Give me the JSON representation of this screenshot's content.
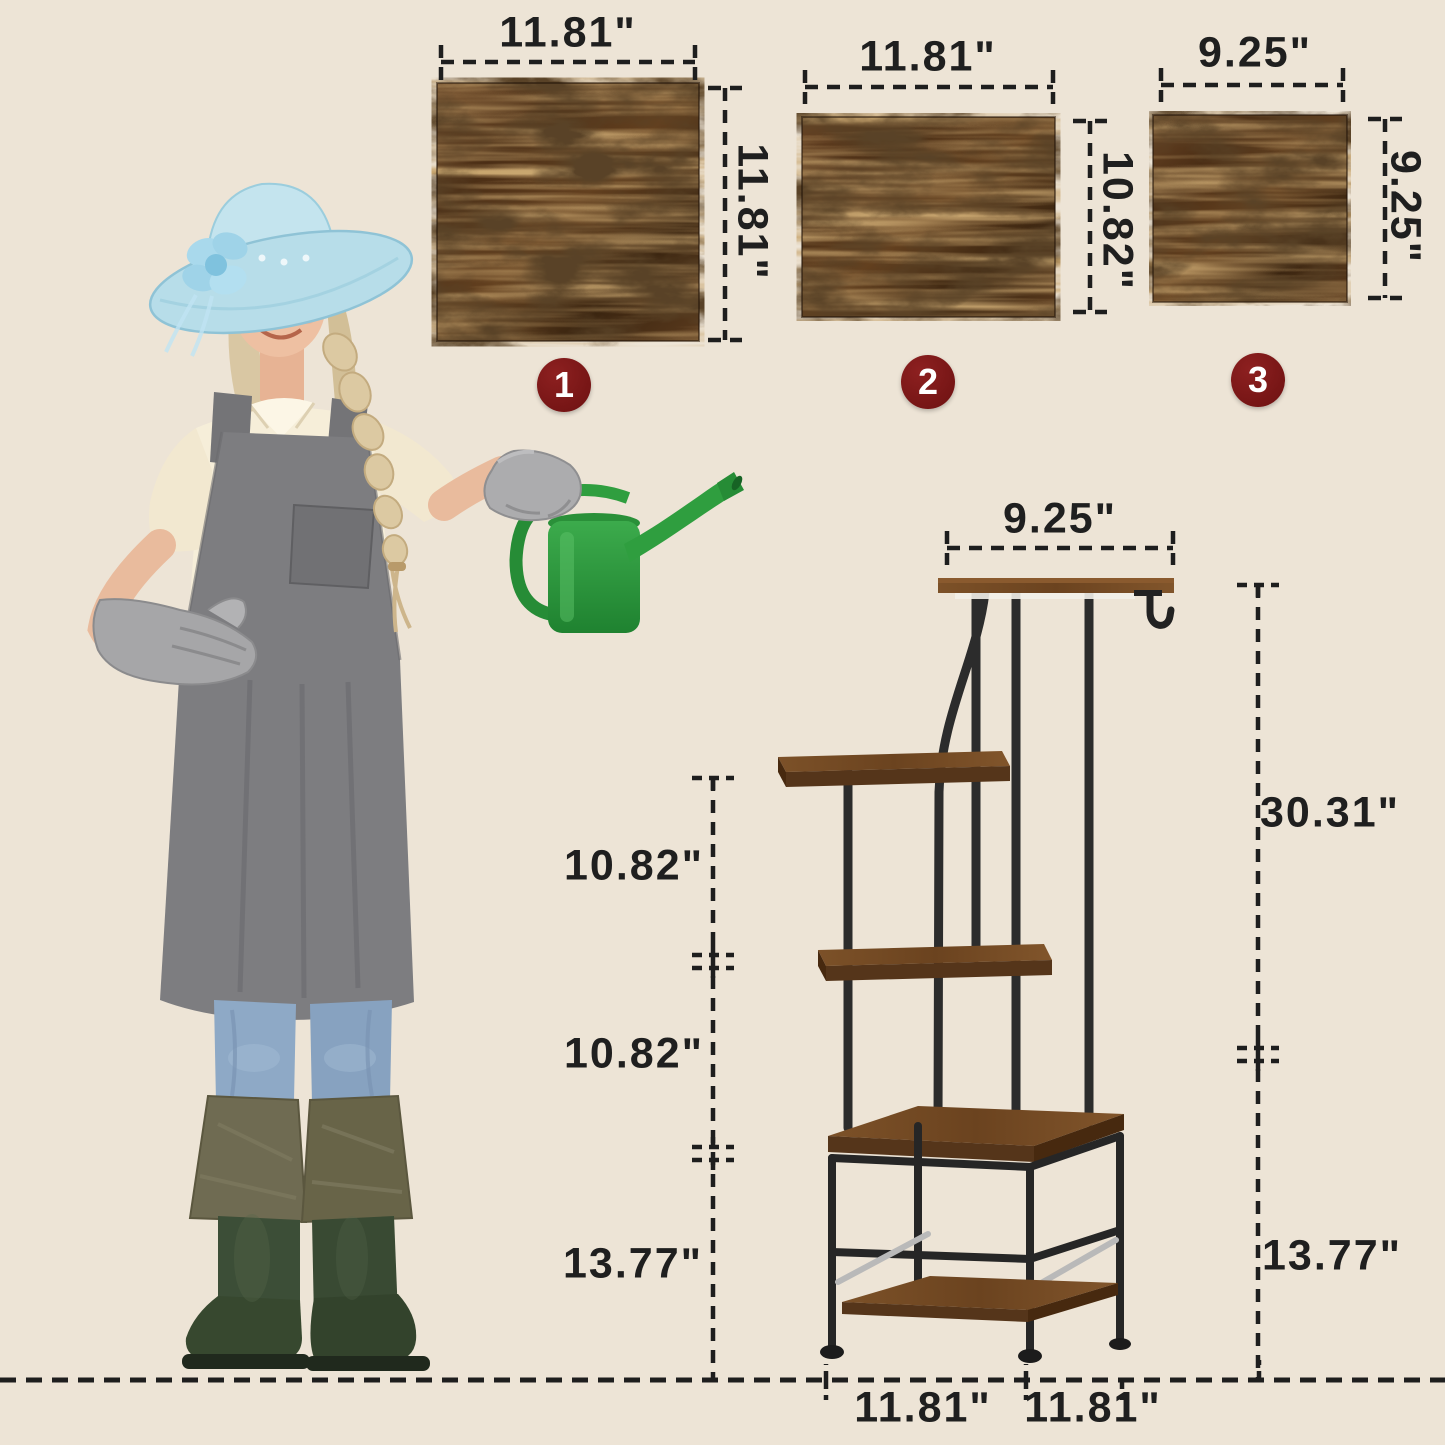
{
  "panels": [
    {
      "num": "1",
      "width_label": "11.81\"",
      "height_label": "11.81\""
    },
    {
      "num": "2",
      "width_label": "11.81\"",
      "height_label": "10.82\""
    },
    {
      "num": "3",
      "width_label": "9.25\"",
      "height_label": "9.25\""
    }
  ],
  "stand": {
    "top_width_label": "9.25\"",
    "left_dim_labels": [
      "10.82\"",
      "10.82\"",
      "13.77\""
    ],
    "right_dim_labels": [
      "30.31\"",
      "13.77\""
    ],
    "base_dim_labels": [
      "11.81\"",
      "11.81\""
    ]
  },
  "colors": {
    "background": "#ede4d6",
    "dimension_text": "#1f1f1f",
    "badge": "#7a1717",
    "wood_dark": "#54351a",
    "wood_light": "#8a5a2e",
    "metal_frame": "#2c2c2c",
    "watering_can_green": "#2f9e3f",
    "hat_blue": "#b7dde9",
    "apron_gray": "#7d7d80"
  }
}
